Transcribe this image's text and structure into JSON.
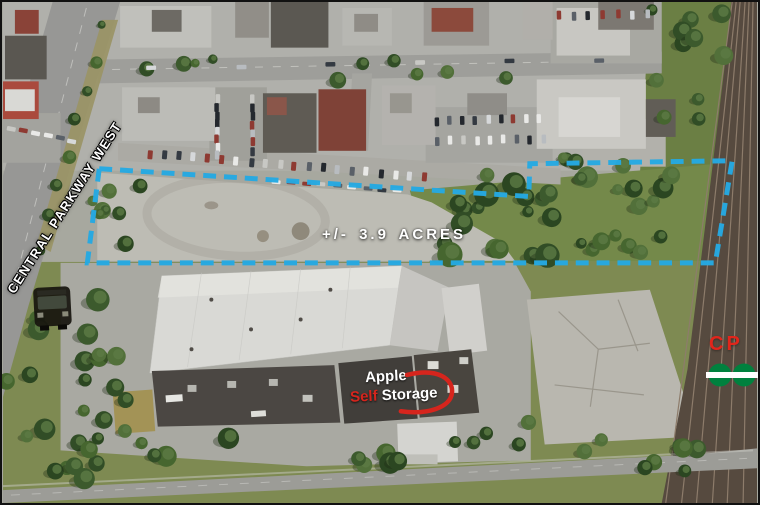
{
  "title": "Aerial property map",
  "labels": {
    "street_name": "CENTRAL PARKWAY WEST",
    "acreage": "+/- 3.9 ACRES",
    "railway": "CP",
    "logo": {
      "word1": "Apple",
      "word2": "Self",
      "word3": "Storage"
    }
  },
  "icons": {
    "bus": "transit-bus-icon",
    "go": "go-transit-logo",
    "swoosh": "logo-swoosh-icon"
  },
  "colors": {
    "property_outline": "#25a9e2",
    "cp_red": "#e1251b",
    "go_green": "#00813e",
    "logo_red": "#d6251d",
    "label_white": "#ffffff"
  },
  "property": {
    "outline_points": "97,168 530,196 531,163 735,160 718,263 85,263"
  }
}
